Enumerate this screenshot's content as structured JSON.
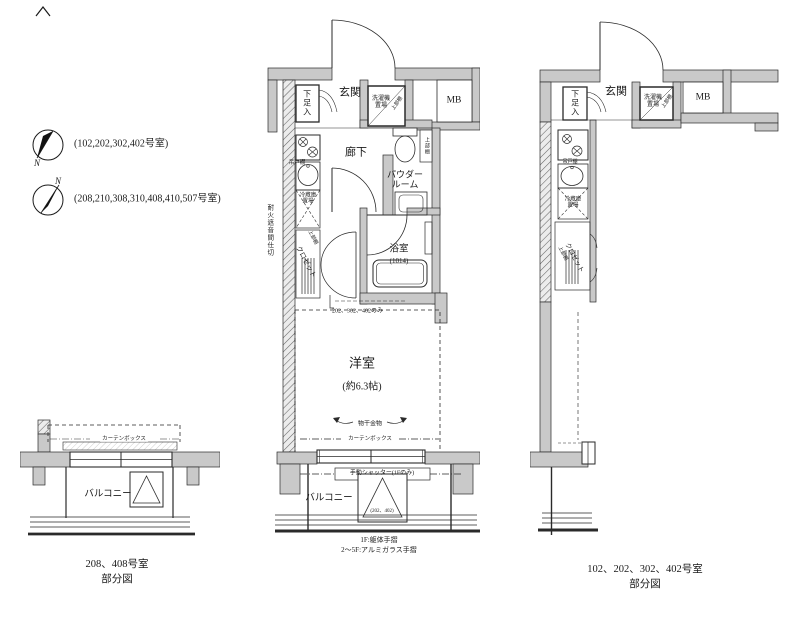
{
  "compass_legend": {
    "north": "N",
    "entries": [
      {
        "rooms": "(102,202,302,402号室)"
      },
      {
        "rooms": "(208,210,308,310,408,410,507号室)"
      }
    ]
  },
  "center_plan": {
    "genkan": "玄関",
    "shoe": "下足入",
    "laundry_line1": "洗濯機",
    "laundry_line2": "置場",
    "laundry_upper": "上部棚",
    "mb": "MB",
    "hallway": "廊下",
    "toilet_shelf": "上部棚",
    "powder_line1": "パウダー",
    "powder_line2": "ルーム",
    "hanging_cabinet": "吊戸棚",
    "fridge_line1": "冷蔵庫",
    "fridge_line2": "置場",
    "closet": "クロゼット",
    "closet_upper": "上部棚",
    "firewall": "耐火遮音間仕切",
    "bath": "浴室",
    "bath_size": "(1014)",
    "note": "202、302、402のみ",
    "western": "洋室",
    "western_size": "(約6.3帖)",
    "drying": "物干金物",
    "curtain_box": "カーテンボックス",
    "shutter": "手動シャッター(1Fのみ)",
    "hatch_rooms": "(202、402)",
    "balcony": "バルコニー",
    "rail_1f": "1F:躯体手摺",
    "rail_2_5f": "2〜5F:アルミガラス手摺"
  },
  "left_partial_plan": {
    "curtain_box": "カーテンボックス",
    "balcony": "バルコニー",
    "caption_line1": "208、408号室",
    "caption_line2": "部分図"
  },
  "right_partial_plan": {
    "genkan": "玄関",
    "shoe": "下足入",
    "laundry_line1": "洗濯機",
    "laundry_line2": "置場",
    "laundry_upper": "上部棚",
    "mb": "MB",
    "hanging_cabinet": "吊戸棚",
    "fridge_line1": "冷蔵庫",
    "fridge_line2": "置場",
    "closet": "クロゼット",
    "closet_upper": "上部棚",
    "caption_line1": "102、202、302、402号室",
    "caption_line2": "部分図"
  }
}
